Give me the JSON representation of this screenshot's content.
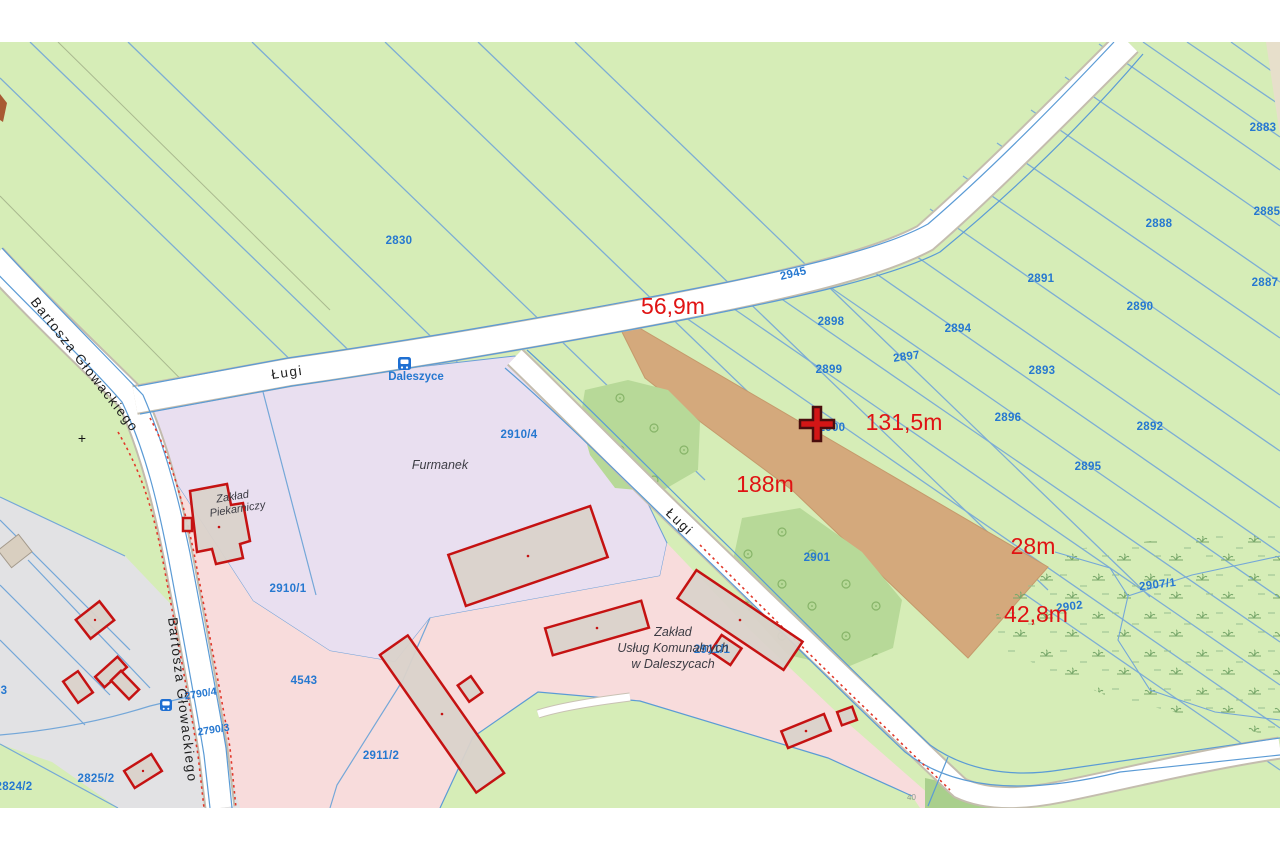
{
  "map": {
    "streets": {
      "bartosza1": "Bartosza Głowackiego",
      "bartosza2": "Bartosza Głowackiego",
      "lugi1": "Ługi",
      "lugi2": "Ługi"
    },
    "place": {
      "daleszyce": "Daleszyce"
    },
    "landmarks": {
      "furmanek": "Furmanek",
      "bakery1": "Zakład",
      "bakery2": "Piekarniczy",
      "zuk1": "Zakład",
      "zuk2": "Usług Komunalnych",
      "zuk3": "w Daleszycach"
    },
    "measurements": {
      "m56": "56,9m",
      "m131": "131,5m",
      "m188": "188m",
      "m28": "28m",
      "m42": "42,8m"
    },
    "parcels": {
      "p2830": "2830",
      "p2945": "2945",
      "p2883": "2883",
      "p2885": "2885",
      "p2887": "2887",
      "p2888": "2888",
      "p2890": "2890",
      "p2891": "2891",
      "p2892": "2892",
      "p2893": "2893",
      "p2894": "2894",
      "p2895": "2895",
      "p2896": "2896",
      "p2897": "2897",
      "p2898": "2898",
      "p2899": "2899",
      "p2900": "2900",
      "p2901": "2901",
      "p2902": "2902",
      "p2907_1": "2907/1",
      "p2910_4": "2910/4",
      "p2910_1": "2910/1",
      "p2911_1": "2911/1",
      "p2911_2": "2911/2",
      "p4543": "4543",
      "p2790_4": "2790/4",
      "p2790_3": "2790/3",
      "p2825_2": "2825/2",
      "p2824_2": "2824/2",
      "p_cut3": "3"
    },
    "symbols": {
      "plus": "+",
      "code40": "40"
    },
    "colors": {
      "field_green": "#d6edb7",
      "tree_green": "#b7d998",
      "plowed_brown": "#d4a97c",
      "residential_grey": "#e2e2e4",
      "industrial_pink": "#f8dcdc",
      "commercial_lavender": "#e9dff0",
      "road_white": "#ffffff",
      "parcel_line_blue": "#5b9bd5",
      "parcel_label_blue": "#2678d0",
      "measurement_red": "#e01313",
      "building_outline_red": "#c51212",
      "building_fill": "#dad2ca"
    }
  }
}
